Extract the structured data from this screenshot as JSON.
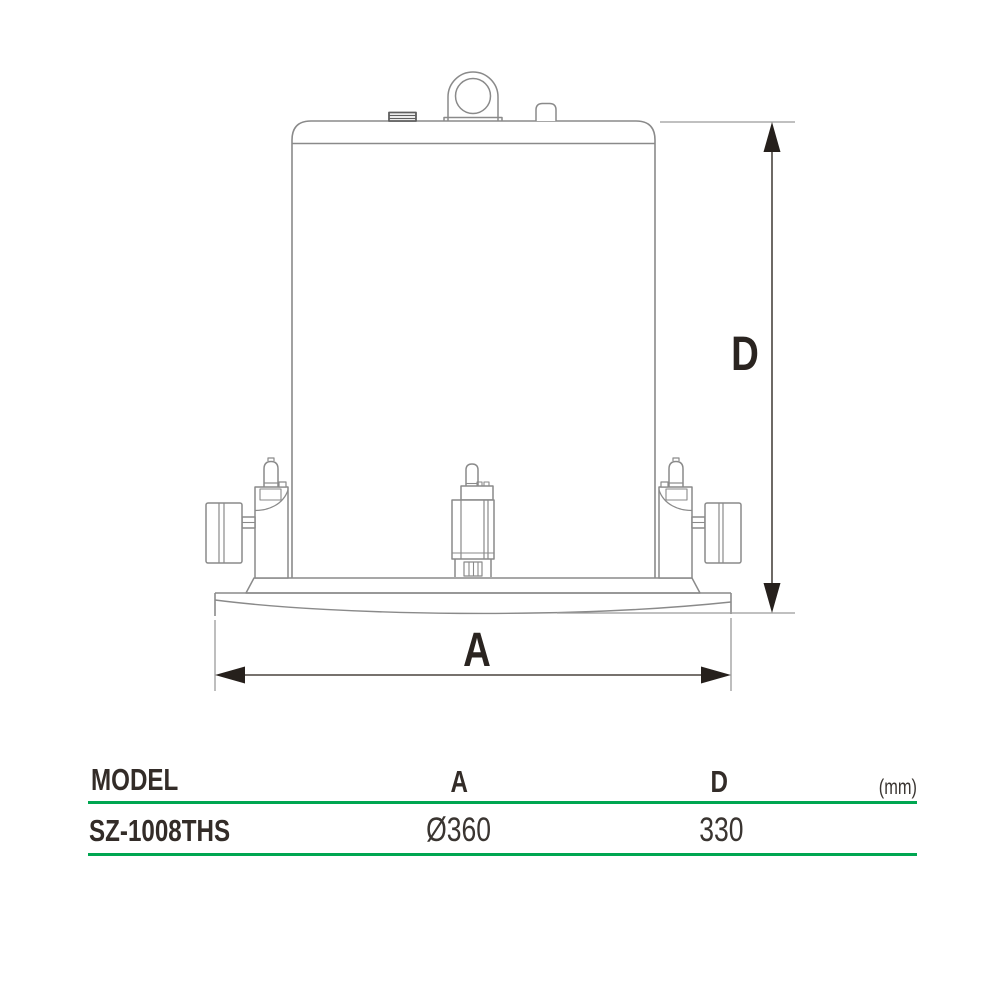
{
  "diagram": {
    "dimension_labels": {
      "a": "A",
      "d": "D"
    }
  },
  "table": {
    "headers": {
      "model": "MODEL",
      "a": "A",
      "d": "D",
      "unit": "(mm)"
    },
    "rows": [
      {
        "model": "SZ-1008THS",
        "a": "Ø360",
        "d": "330"
      }
    ]
  },
  "colors": {
    "accent_green": "#00a651",
    "drawing_line_gray": "#8a8a8a",
    "dimension_line": "#4a443f",
    "arrowhead": "#26201c",
    "text_dark": "#332c28"
  }
}
